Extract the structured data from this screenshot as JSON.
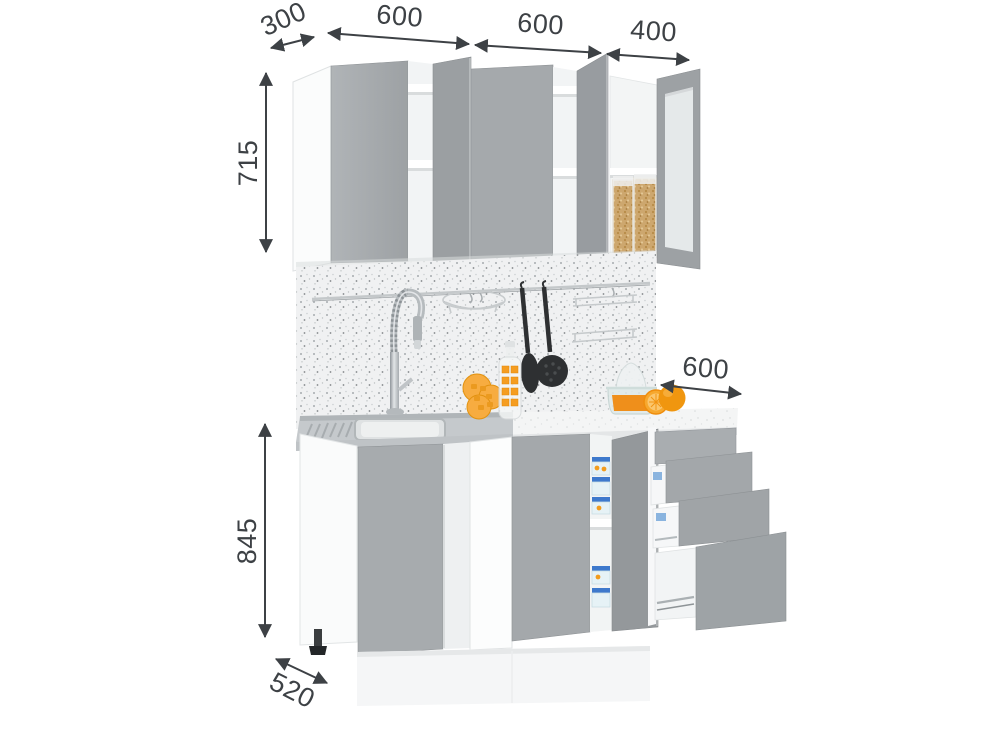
{
  "figure": {
    "type": "kitchen-cabinet-set-dimension-render",
    "background": "#ffffff"
  },
  "dimensions": {
    "upper_depth": "300",
    "upper_width_left": "600",
    "upper_width_center": "600",
    "upper_width_right": "400",
    "upper_height": "715",
    "counter_depth": "600",
    "base_height": "845",
    "base_depth": "520"
  },
  "colors": {
    "door_grey": "#a6aaad",
    "door_grey_dark": "#94989b",
    "carcass_white": "#fafbfb",
    "backsplash_speckle": "#f0f1f2",
    "countertop_white": "#f4f5f5",
    "stainless_steel": "#c5c9cc",
    "utensil_black": "#2e3032",
    "accent_orange": "#f29c1e",
    "container_blue": "#3e79cc",
    "grain_tan": "#cda76e",
    "dimension_ink": "#3d4145"
  }
}
